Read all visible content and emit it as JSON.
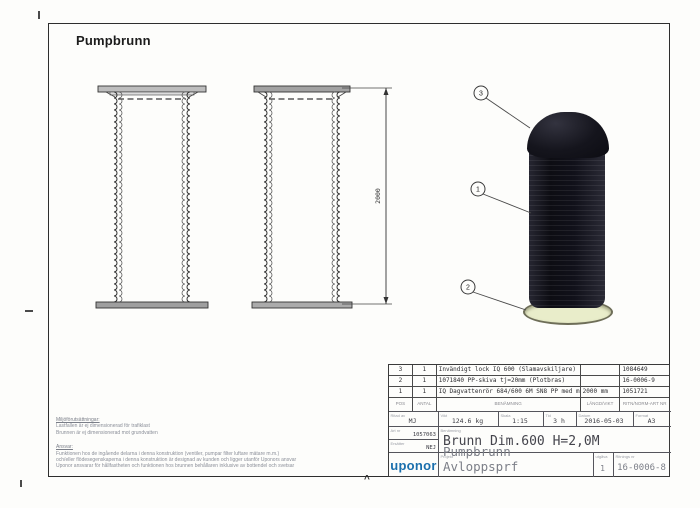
{
  "page": {
    "title": "Pumpbrunn"
  },
  "accent_colors": {
    "logo_blue": "#1a6fad",
    "render_black": "#11111a",
    "ring_pale": "#e9edca"
  },
  "views": {
    "dimension_label": "2000"
  },
  "balloons": {
    "top": "3",
    "middle": "1",
    "bottom": "2"
  },
  "parts_table": {
    "headers": {
      "pos": "POS",
      "antal": "ANTAL",
      "benamning": "BENÄMNING",
      "langd": "LÄNGD/VIKT",
      "artnr": "RITN/NORM-ART NR"
    },
    "rows": [
      {
        "pos": "3",
        "antal": "1",
        "benamning": "Invändigt lock IQ 600 (Slamavskiljare)",
        "langd": "",
        "artnr": "1084649"
      },
      {
        "pos": "2",
        "antal": "1",
        "benamning": "1071840  PP-skiva tj=20mm  (Plotbras)",
        "langd": "",
        "artnr": "16-0006-9"
      },
      {
        "pos": "1",
        "antal": "1",
        "benamning": "IQ Dagvattenrör 684/600 6M SN8 PP med muff",
        "langd": "2000 mm",
        "artnr": "1051721"
      }
    ]
  },
  "title_block": {
    "labels": {
      "ritad": "Ritad av",
      "vikt": "Vikt",
      "skala": "Skala",
      "tid": "Tid",
      "datum": "Datum",
      "format": "Format",
      "artnr": "Art nr",
      "ersatter": "Ersätter",
      "benamning": "Benämning",
      "projekt": "Projekt",
      "utgava": "utgåva",
      "ritningsnr": "Ritnings nr"
    },
    "values": {
      "ritad": "MJ",
      "vikt": "124.6 kg",
      "skala": "1:15",
      "tid": "3 h",
      "datum": "2016-05-03",
      "format": "A3",
      "artnr": "1057063",
      "ersatter": "NEJ",
      "benamning": "Brunn Dim.600 H=2,0M",
      "projekt": "Pumpbrunn Avloppsprf",
      "utgava": "1",
      "ritningsnr": "16-0006-8",
      "logo": "uponor"
    }
  },
  "notes": {
    "env_heading": "Miljöförutsättningar:",
    "env_lines": [
      "Lastfallen är ej dimensionerad för trafiklast",
      "Brunnen är ej dimensionerad mot grundvatten"
    ],
    "resp_heading": "Ansvar:",
    "resp_lines": [
      "Funktionen hos de ingående delarna i denna konstruktion (ventiler, pumpar filter luftare mätare m.m.)",
      "och/eller flödesegenskaperna i denna konstruktion är designad av kunden och ligger utanför Uponors ansvar",
      "Uponor ansvarar för hållfastheten och funktionen hos brunnen behållaren inklusive av bottendel och svetsar"
    ]
  }
}
